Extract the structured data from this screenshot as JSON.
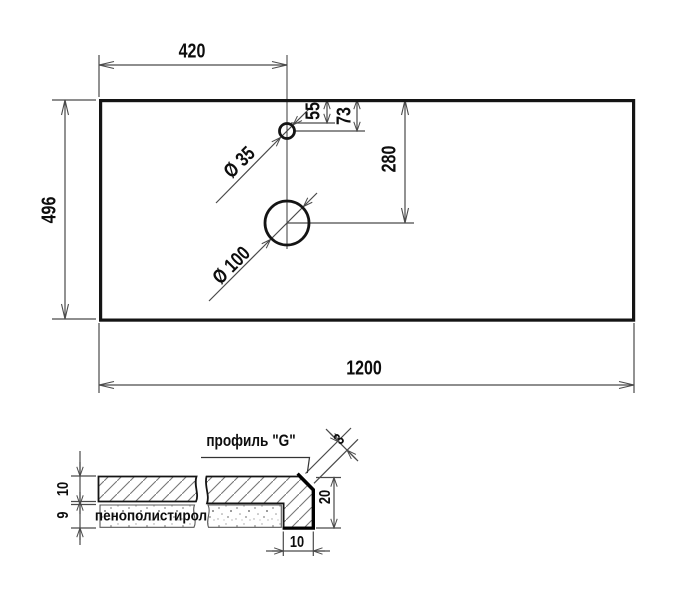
{
  "top_view": {
    "dim_width": "1200",
    "dim_height": "496",
    "dim_hole_offset": "420",
    "dim_small_hole_edge": "55",
    "dim_small_hole_center": "73",
    "dim_large_hole_center": "280",
    "small_hole_diameter": "Ø 35",
    "large_hole_diameter": "Ø 100"
  },
  "section_view": {
    "profile_label": "профиль \"G\"",
    "foam_label": "пенополистирол",
    "dim_profile_thickness": "3",
    "dim_top_layer_thickness": "10",
    "dim_foam_layer_thickness": "9",
    "dim_edge_height": "20",
    "dim_edge_width": "10"
  },
  "colors": {
    "outline": "#141414",
    "dimension_lines": "#4a4a4a",
    "hatch": "#777777",
    "background": "#ffffff"
  }
}
